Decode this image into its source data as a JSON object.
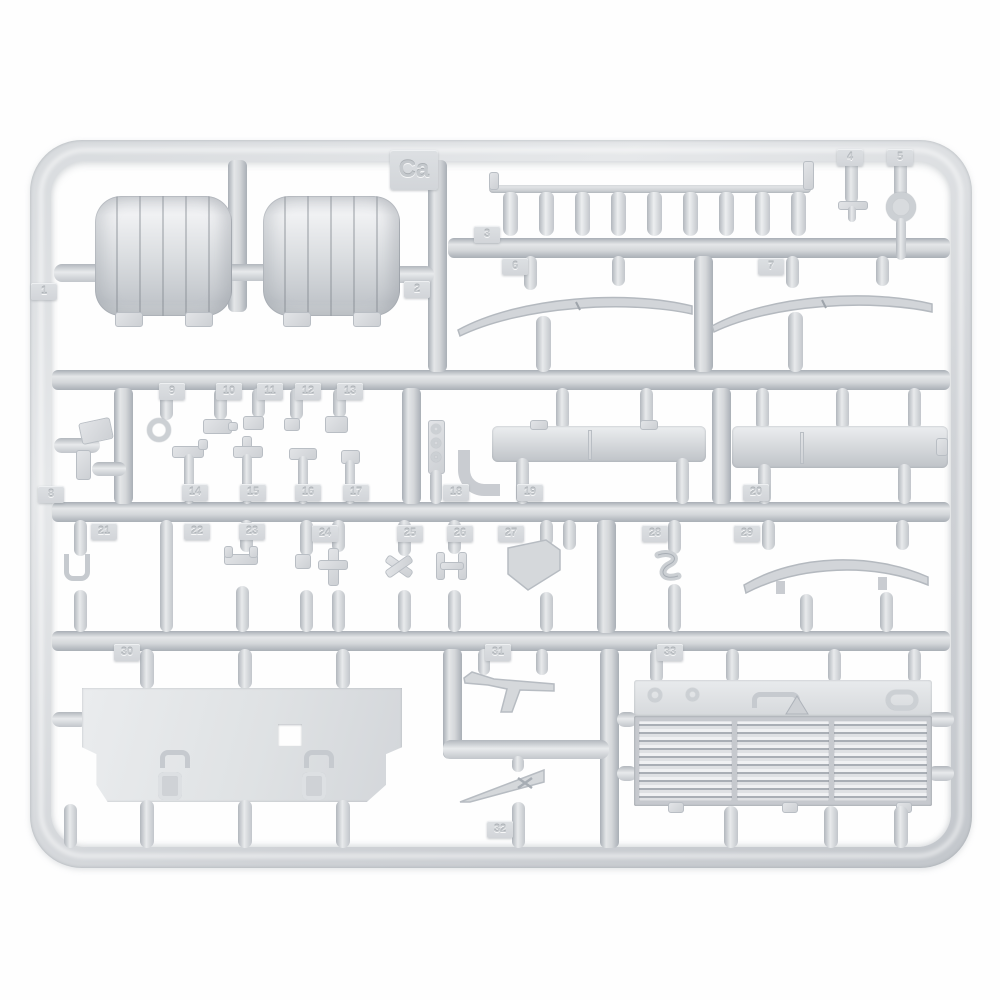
{
  "sprue_letter": "Ca",
  "part_tags": [
    "1",
    "2",
    "3",
    "4",
    "5",
    "6",
    "7",
    "8",
    "9",
    "10",
    "11",
    "12",
    "13",
    "14",
    "15",
    "16",
    "17",
    "18",
    "19",
    "20",
    "21",
    "22",
    "23",
    "24",
    "25",
    "26",
    "27",
    "28",
    "29",
    "30",
    "31",
    "32",
    "33"
  ],
  "colors": {
    "background": "#ffffff",
    "plastic_light": "#e8eaec",
    "plastic_mid": "#d3d6da",
    "plastic_dark": "#aab0b7",
    "tag_text": "#c5c9cd"
  }
}
